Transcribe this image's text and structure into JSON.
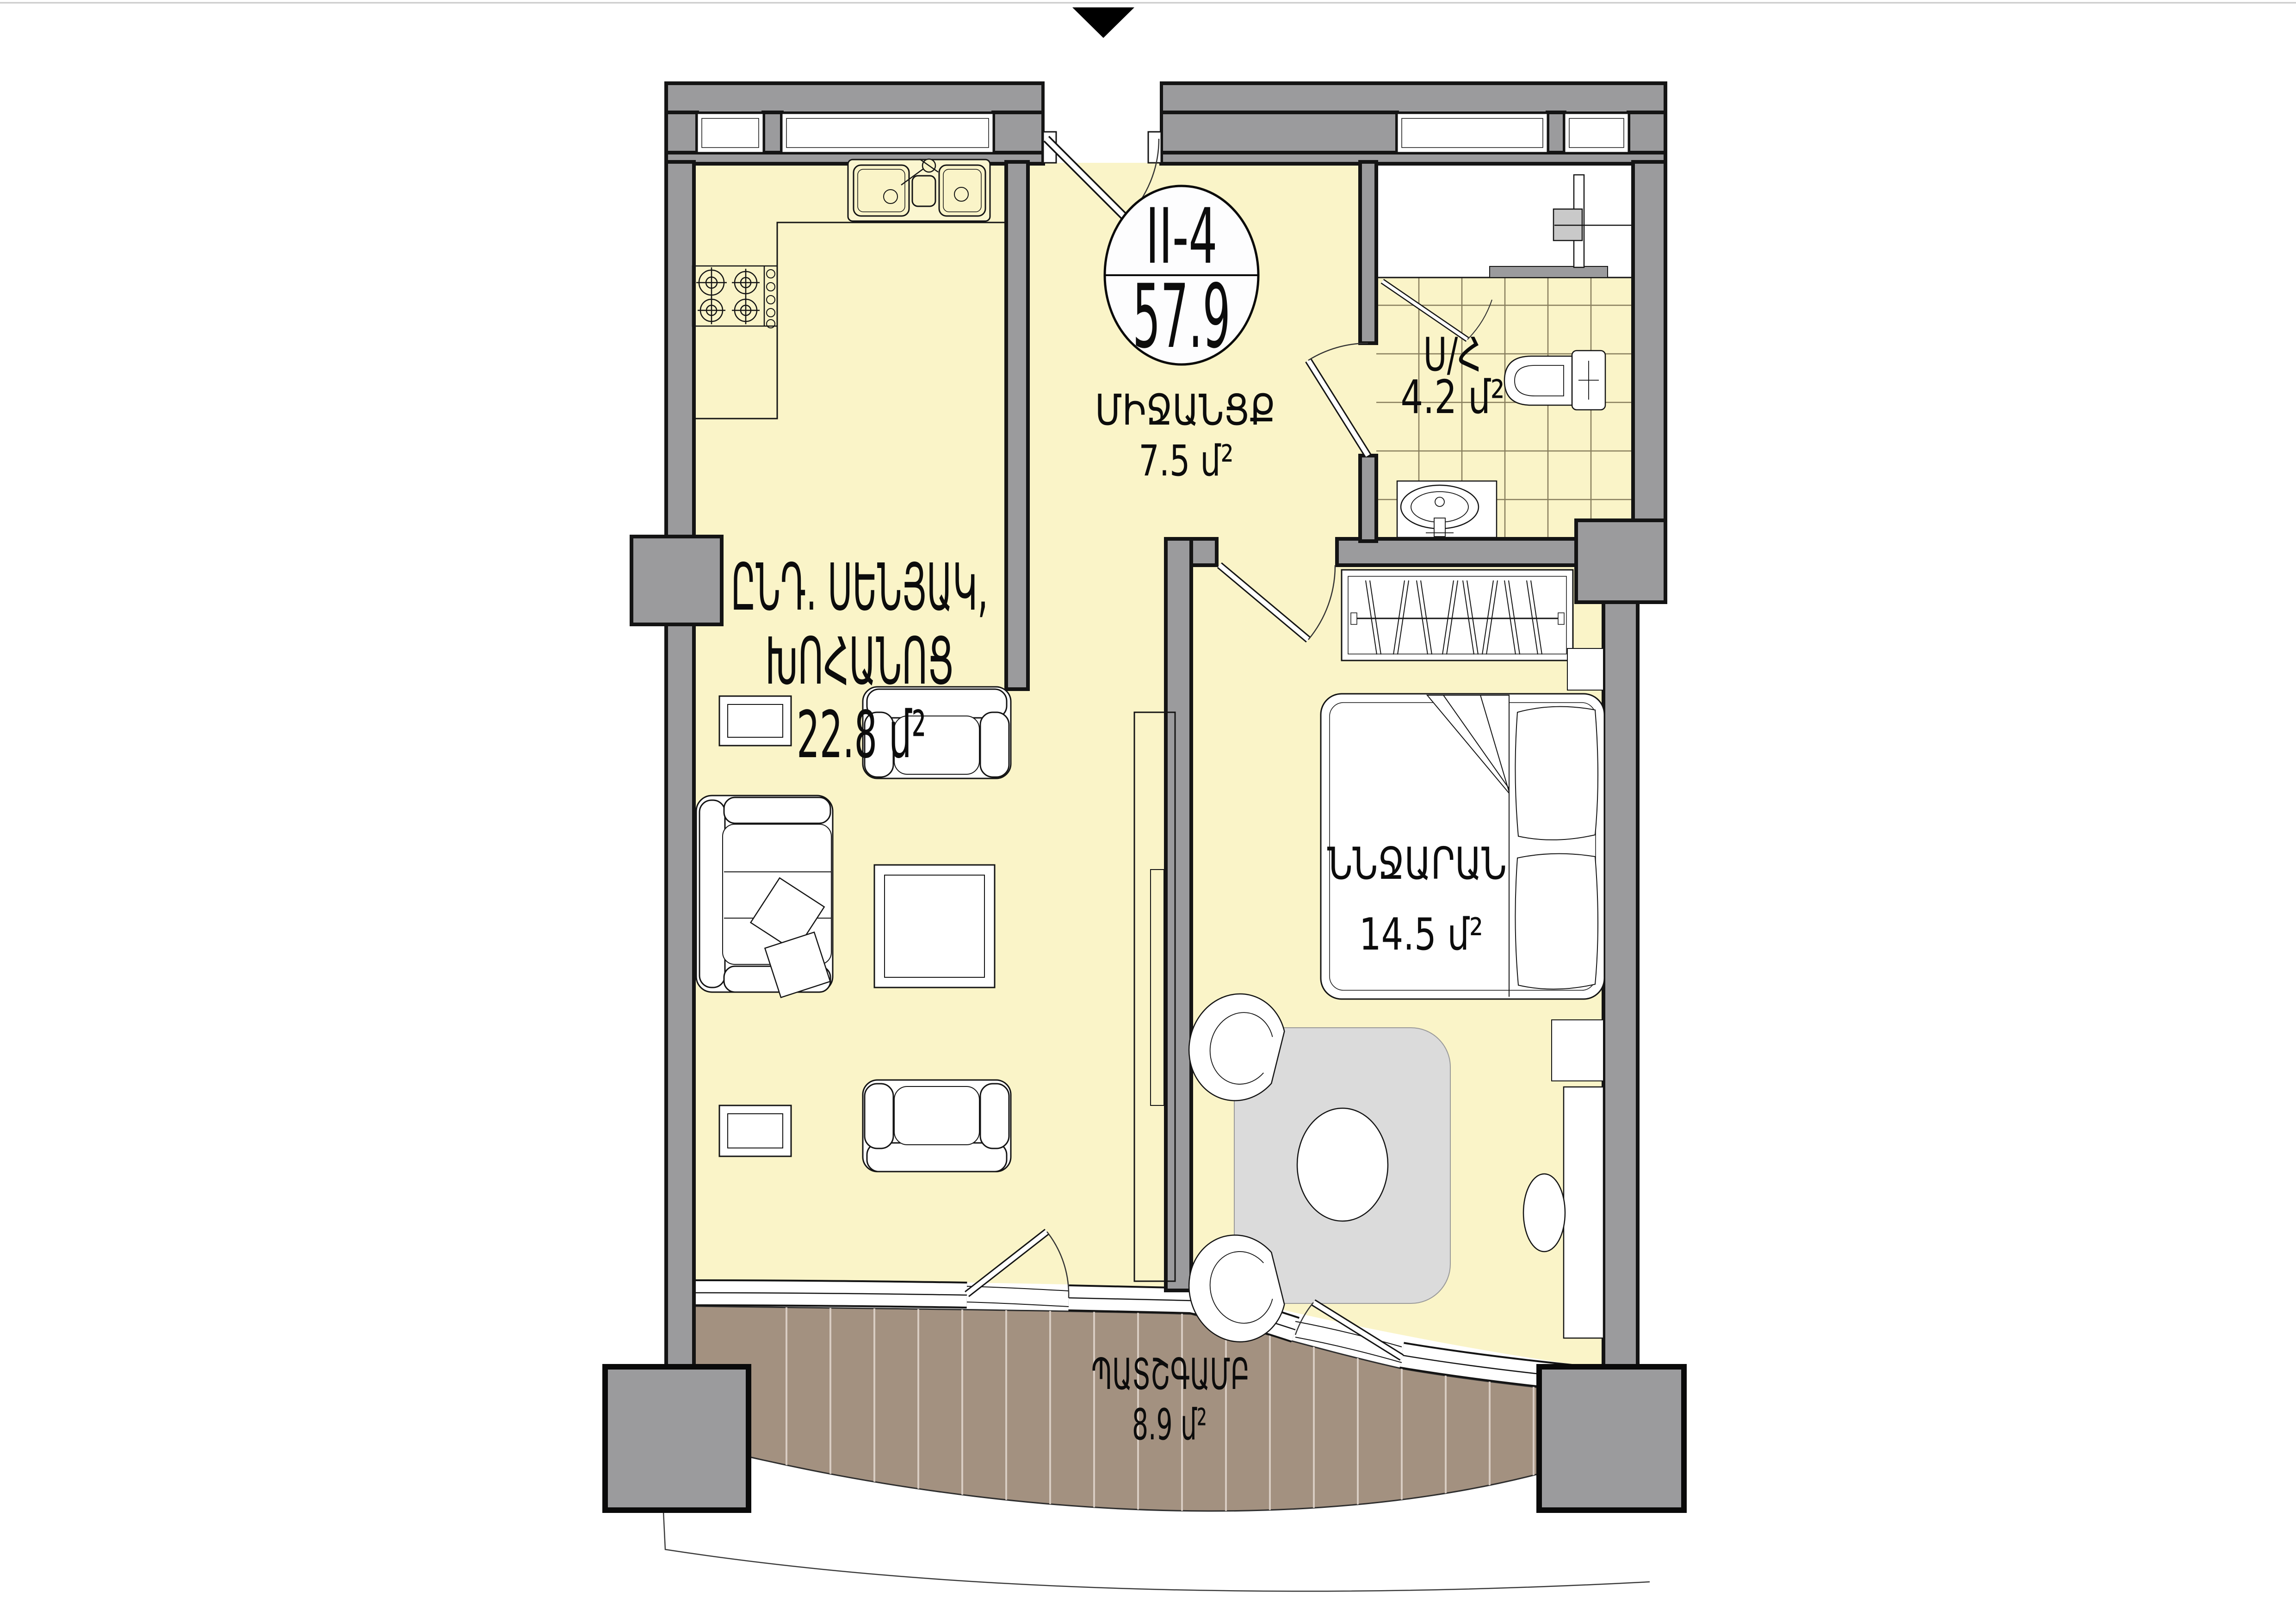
{
  "unit": {
    "id": "II-4",
    "area": "57.9"
  },
  "marker": {
    "icon": "entrance-triangle-icon",
    "shape": "triangle-down",
    "color": "#000000"
  },
  "rooms": {
    "hallway": {
      "name": "ՄԻՋԱՆՑՔ",
      "area": "7.5 մ²"
    },
    "bathroom": {
      "name": "Ս/Հ",
      "area": "4.2 մ²"
    },
    "living": {
      "line1": "ԸՆԴ. ՍԵՆՅԱԿ,",
      "line2": "ԽՈՀԱՆՈՑ",
      "area": "22.8 մ²"
    },
    "bedroom": {
      "name": "ՆՆՋԱՐԱՆ",
      "area": "14.5 մ²"
    },
    "balcony": {
      "name": "ՊԱՏՇԳԱՄԲ",
      "area": "8.9 մ²"
    }
  },
  "colors": {
    "floor": "#FAF4C8",
    "wall": "#9B9B9D",
    "outline": "#141414",
    "deck": "#A39180",
    "plank_line": "#D8CCC2",
    "rug": "#DBDBDB",
    "badge_fill": "#FDFDFE"
  }
}
